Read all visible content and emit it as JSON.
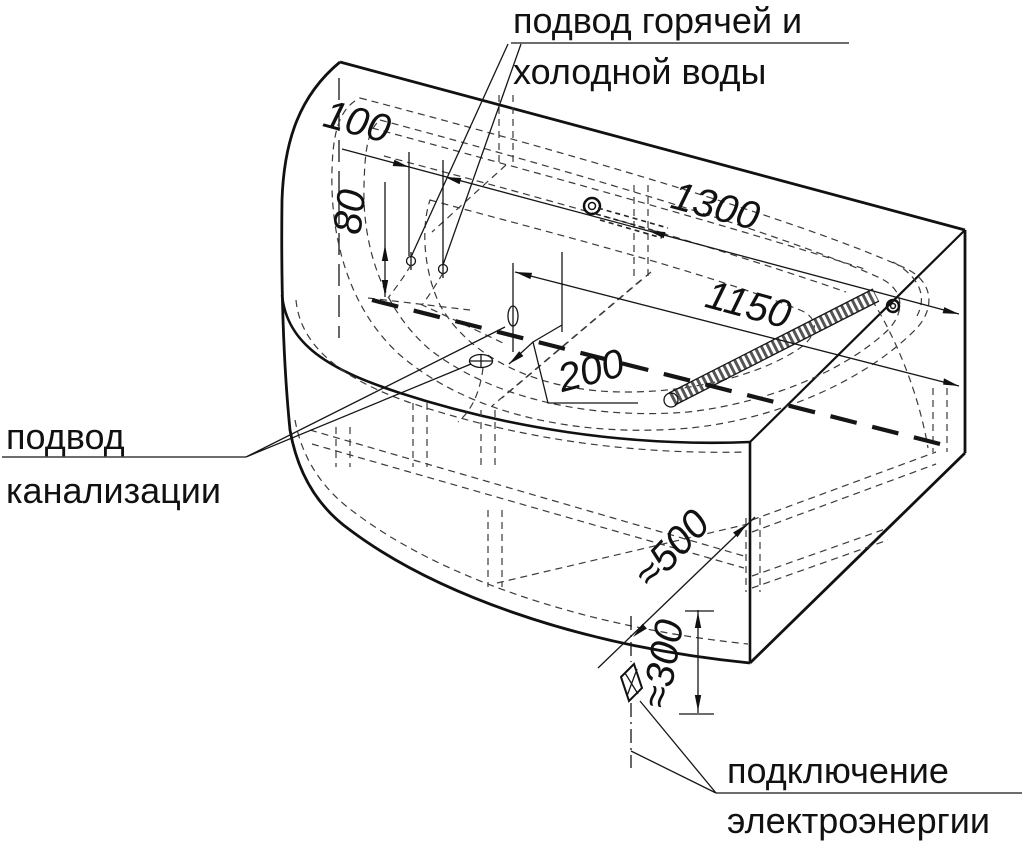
{
  "labels": {
    "water_line1": "подвод горячей и",
    "water_line2": "холодной воды",
    "sewer_line1": "подвод",
    "sewer_line2": "канализации",
    "electric_line1": "подключение",
    "electric_line2": "электроэнергии"
  },
  "dimensions": {
    "pipe_spacing": "100",
    "pipe_height": "80",
    "overall_length": "1300",
    "drain_to_wall": "1150",
    "drain_offset": "200",
    "outlet_diagonal": "≈500",
    "outlet_height": "≈300"
  },
  "colors": {
    "line": "#111111",
    "hidden_line": "#3a3a3a",
    "background": "#ffffff"
  }
}
